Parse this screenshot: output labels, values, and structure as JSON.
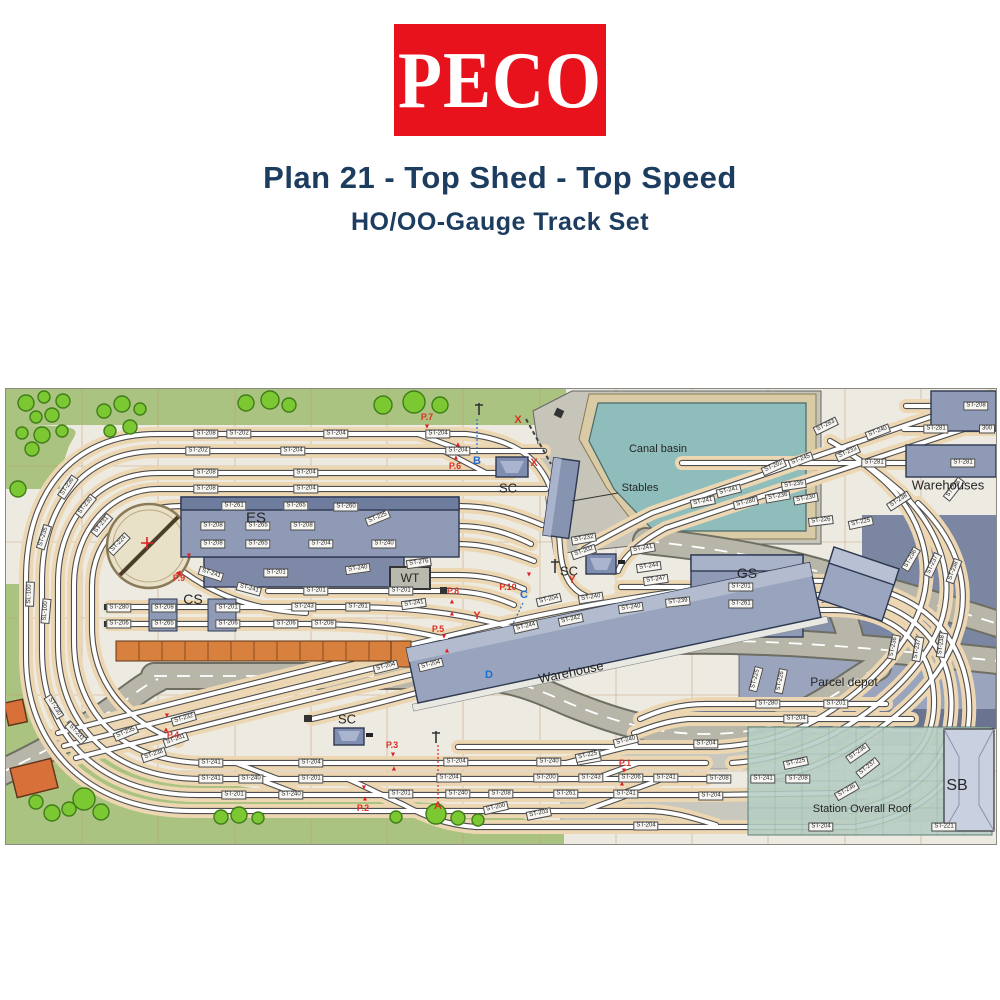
{
  "header": {
    "logo": "PECO",
    "title": "Plan 21 - Top Shed - Top Speed",
    "subtitle": "HO/OO-Gauge Track Set"
  },
  "colors": {
    "peco_red": "#e8121c",
    "navy": "#1d3d60",
    "plan_bg": "#edeae2",
    "grass": "#abc381",
    "tree": "#7cc832",
    "water": "#8fbdbb",
    "wharf": "#c7c5ba",
    "ballast": "#ecd7b2",
    "slate": "#8e9ab6",
    "orange": "#d8813f",
    "road": "#b7b6a9",
    "roof": "#b4cdc4",
    "red": "#d93025",
    "blue": "#1e6fd0"
  },
  "plan": {
    "area_labels": [
      [
        "Canal basin",
        652,
        60,
        11,
        0
      ],
      [
        "Stables",
        634,
        99,
        11,
        0
      ],
      [
        "Warehouses",
        942,
        96,
        13,
        0
      ],
      [
        "ES",
        250,
        129,
        15,
        0
      ],
      [
        "CS",
        187,
        210,
        14,
        0
      ],
      [
        "WT",
        404,
        189,
        12,
        0
      ],
      [
        "SC",
        502,
        99,
        13,
        0
      ],
      [
        "SC",
        563,
        182,
        13,
        0
      ],
      [
        "SC",
        341,
        330,
        13,
        0
      ],
      [
        "GS",
        741,
        184,
        14,
        0
      ],
      [
        "Warehouse",
        565,
        283,
        13,
        -12
      ],
      [
        "Parcel depot",
        838,
        293,
        12,
        0
      ],
      [
        "Station Overall Roof",
        856,
        420,
        11,
        0
      ],
      [
        "SB",
        951,
        397,
        16,
        0
      ]
    ],
    "point_labels": [
      [
        "P.1",
        619,
        374
      ],
      [
        "P.2",
        357,
        419
      ],
      [
        "P.3",
        386,
        356
      ],
      [
        "P.4",
        167,
        346
      ],
      [
        "P.5",
        432,
        240
      ],
      [
        "P.6",
        449,
        77
      ],
      [
        "P.7",
        421,
        28
      ],
      [
        "P.8",
        447,
        202
      ],
      [
        "P.9",
        173,
        189
      ],
      [
        "P.10",
        502,
        198
      ]
    ],
    "letters": [
      [
        "A",
        432,
        417,
        "r"
      ],
      [
        "B",
        471,
        72,
        "b"
      ],
      [
        "C",
        518,
        206,
        "b"
      ],
      [
        "D",
        483,
        286,
        "b"
      ],
      [
        "X",
        512,
        31,
        "r"
      ],
      [
        "X",
        528,
        74,
        "r"
      ],
      [
        "Y",
        566,
        191,
        "r"
      ],
      [
        "Y",
        471,
        227,
        "r"
      ]
    ],
    "arrows": [
      [
        421,
        38,
        "d"
      ],
      [
        452,
        56,
        "u"
      ],
      [
        450,
        69,
        "u"
      ],
      [
        446,
        213,
        "u"
      ],
      [
        446,
        225,
        "u"
      ],
      [
        438,
        248,
        "d"
      ],
      [
        441,
        262,
        "u"
      ],
      [
        183,
        167,
        "d"
      ],
      [
        172,
        184,
        "l"
      ],
      [
        161,
        327,
        "d"
      ],
      [
        160,
        341,
        "u"
      ],
      [
        387,
        366,
        "d"
      ],
      [
        388,
        380,
        "u"
      ],
      [
        358,
        399,
        "d"
      ],
      [
        359,
        410,
        "u"
      ],
      [
        618,
        382,
        "d"
      ],
      [
        616,
        395,
        "u"
      ],
      [
        523,
        186,
        "d"
      ]
    ],
    "st_labels": [
      [
        "ST-208",
        200,
        45
      ],
      [
        "ST-202",
        233,
        45
      ],
      [
        "ST-204",
        330,
        45
      ],
      [
        "ST-204",
        432,
        45
      ],
      [
        "ST-202",
        192,
        62
      ],
      [
        "ST-204",
        287,
        62
      ],
      [
        "ST-204",
        452,
        62
      ],
      [
        "ST-208",
        200,
        84
      ],
      [
        "ST-204",
        300,
        84
      ],
      [
        "ST-208",
        200,
        100
      ],
      [
        "ST-204",
        300,
        100
      ],
      [
        "ST-236",
        62,
        98,
        -55
      ],
      [
        "ST-230",
        80,
        117,
        -52
      ],
      [
        "ST-231",
        96,
        136,
        -50
      ],
      [
        "ST-224",
        113,
        155,
        -46
      ],
      [
        "ST-235",
        38,
        148,
        -72
      ],
      [
        "SL-100",
        24,
        205,
        -88
      ],
      [
        "SL-100",
        40,
        222,
        -85
      ],
      [
        "ST-230",
        48,
        318,
        58
      ],
      [
        "ST-231",
        70,
        344,
        48
      ],
      [
        "ST-261",
        228,
        117
      ],
      [
        "ST-265",
        290,
        117
      ],
      [
        "ST-260",
        340,
        118
      ],
      [
        "ST-208",
        207,
        137
      ],
      [
        "ST-265",
        252,
        137
      ],
      [
        "ST-208",
        297,
        137
      ],
      [
        "ST-225",
        372,
        129,
        -22
      ],
      [
        "ST-208",
        207,
        155
      ],
      [
        "ST-265",
        252,
        155
      ],
      [
        "ST-204",
        315,
        155
      ],
      [
        "ST-240",
        378,
        155
      ],
      [
        "ST-241",
        205,
        185,
        18
      ],
      [
        "ST-201",
        270,
        184
      ],
      [
        "ST-240",
        352,
        180,
        -8
      ],
      [
        "ST-276",
        413,
        174,
        -8
      ],
      [
        "ST-241",
        243,
        200,
        15
      ],
      [
        "ST-201",
        310,
        202
      ],
      [
        "ST-201",
        395,
        202
      ],
      [
        "ST-243",
        298,
        218
      ],
      [
        "ST-261",
        352,
        218
      ],
      [
        "ST-241",
        408,
        215,
        -8
      ],
      [
        "ST-280",
        113,
        219
      ],
      [
        "ST-208",
        158,
        219
      ],
      [
        "ST-201",
        222,
        219
      ],
      [
        "ST-206",
        113,
        235
      ],
      [
        "ST-265",
        158,
        235
      ],
      [
        "ST-206",
        222,
        235
      ],
      [
        "ST-206",
        280,
        235
      ],
      [
        "ST-208",
        318,
        235
      ],
      [
        "ST-204",
        380,
        278,
        -14
      ],
      [
        "ST-204",
        425,
        276,
        -14
      ],
      [
        "ST-244",
        520,
        238,
        -13
      ],
      [
        "ST-242",
        565,
        231,
        -12
      ],
      [
        "ST-204",
        543,
        211,
        -13
      ],
      [
        "ST-240",
        625,
        219,
        -8
      ],
      [
        "ST-239",
        672,
        213,
        -6
      ],
      [
        "ST-240",
        585,
        209,
        -9
      ],
      [
        "ST-232",
        578,
        150,
        -10
      ],
      [
        "ST-241",
        637,
        160,
        -10
      ],
      [
        "ST-244",
        643,
        178,
        -8
      ],
      [
        "ST-247",
        650,
        191,
        -8
      ],
      [
        "ST-202",
        578,
        163,
        -18
      ],
      [
        "ST-283",
        820,
        37,
        -26
      ],
      [
        "ST-240",
        872,
        43,
        -21
      ],
      [
        "ST-233",
        842,
        64,
        -24
      ],
      [
        "ST-245",
        795,
        71,
        -21
      ],
      [
        "ST-202",
        768,
        78,
        -24
      ],
      [
        "ST-241",
        723,
        102,
        -14
      ],
      [
        "ST-241",
        697,
        113,
        -11
      ],
      [
        "ST-280",
        740,
        114,
        -13
      ],
      [
        "ST-281",
        868,
        74
      ],
      [
        "ST-281",
        957,
        74
      ],
      [
        "ST-208",
        970,
        17
      ],
      [
        "ST-281",
        930,
        40
      ],
      [
        "300",
        981,
        40
      ],
      [
        "ST-235",
        788,
        96,
        -8
      ],
      [
        "ST-236",
        772,
        108,
        -10
      ],
      [
        "ST-230",
        800,
        110,
        -10
      ],
      [
        "ST-238",
        893,
        112,
        -33
      ],
      [
        "ST-235",
        948,
        100,
        -52
      ],
      [
        "ST-226",
        815,
        132,
        -7
      ],
      [
        "ST-225",
        855,
        134,
        -12
      ],
      [
        "ST-236",
        905,
        170,
        -60
      ],
      [
        "ST-237",
        927,
        176,
        -65
      ],
      [
        "ST-238",
        948,
        182,
        -70
      ],
      [
        "ST-236",
        888,
        258,
        -78
      ],
      [
        "ST-237",
        912,
        260,
        -80
      ],
      [
        "ST-238",
        936,
        256,
        -82
      ],
      [
        "ST-225",
        750,
        290,
        -75
      ],
      [
        "ST-226",
        775,
        292,
        -78
      ],
      [
        "ST-280",
        762,
        315
      ],
      [
        "ST-201",
        830,
        315
      ],
      [
        "ST-204",
        790,
        330
      ],
      [
        "ST-241",
        205,
        374
      ],
      [
        "ST-204",
        305,
        374
      ],
      [
        "ST-204",
        450,
        373
      ],
      [
        "ST-240",
        543,
        373
      ],
      [
        "ST-203",
        583,
        370,
        -10
      ],
      [
        "ST-241",
        205,
        390
      ],
      [
        "ST-240",
        245,
        390
      ],
      [
        "ST-201",
        305,
        390
      ],
      [
        "ST-204",
        443,
        389
      ],
      [
        "ST-200",
        540,
        389
      ],
      [
        "ST-243",
        585,
        389
      ],
      [
        "ST-206",
        625,
        389
      ],
      [
        "ST-241",
        660,
        389
      ],
      [
        "ST-201",
        228,
        406
      ],
      [
        "ST-240",
        285,
        406
      ],
      [
        "ST-201",
        395,
        405
      ],
      [
        "ST-240",
        452,
        405
      ],
      [
        "ST-208",
        495,
        405
      ],
      [
        "ST-261",
        560,
        405
      ],
      [
        "ST-241",
        620,
        405
      ],
      [
        "ST-200",
        490,
        419,
        -13
      ],
      [
        "ST-203",
        533,
        425,
        -11
      ],
      [
        "ST-204",
        640,
        437
      ],
      [
        "ST-238",
        148,
        366,
        -18
      ],
      [
        "ST-231",
        170,
        351,
        -19
      ],
      [
        "ST-232",
        178,
        330,
        -16
      ],
      [
        "ST-235",
        120,
        344,
        -22
      ],
      [
        "ST-204",
        700,
        355
      ],
      [
        "ST-240",
        620,
        352,
        -14
      ],
      [
        "ST-225",
        582,
        367,
        -12
      ],
      [
        "ST-208",
        713,
        390
      ],
      [
        "ST-241",
        757,
        390
      ],
      [
        "ST-208",
        792,
        390
      ],
      [
        "ST-204",
        705,
        407
      ],
      [
        "ST-225",
        790,
        374,
        -12
      ],
      [
        "ST-236",
        852,
        364,
        -35
      ],
      [
        "ST-237",
        862,
        379,
        -38
      ],
      [
        "ST-236",
        841,
        402,
        -30
      ],
      [
        "ST-204",
        815,
        438
      ],
      [
        "ST-221",
        938,
        438
      ],
      [
        "ST-201",
        735,
        198
      ],
      [
        "ST-261",
        735,
        215
      ]
    ]
  }
}
